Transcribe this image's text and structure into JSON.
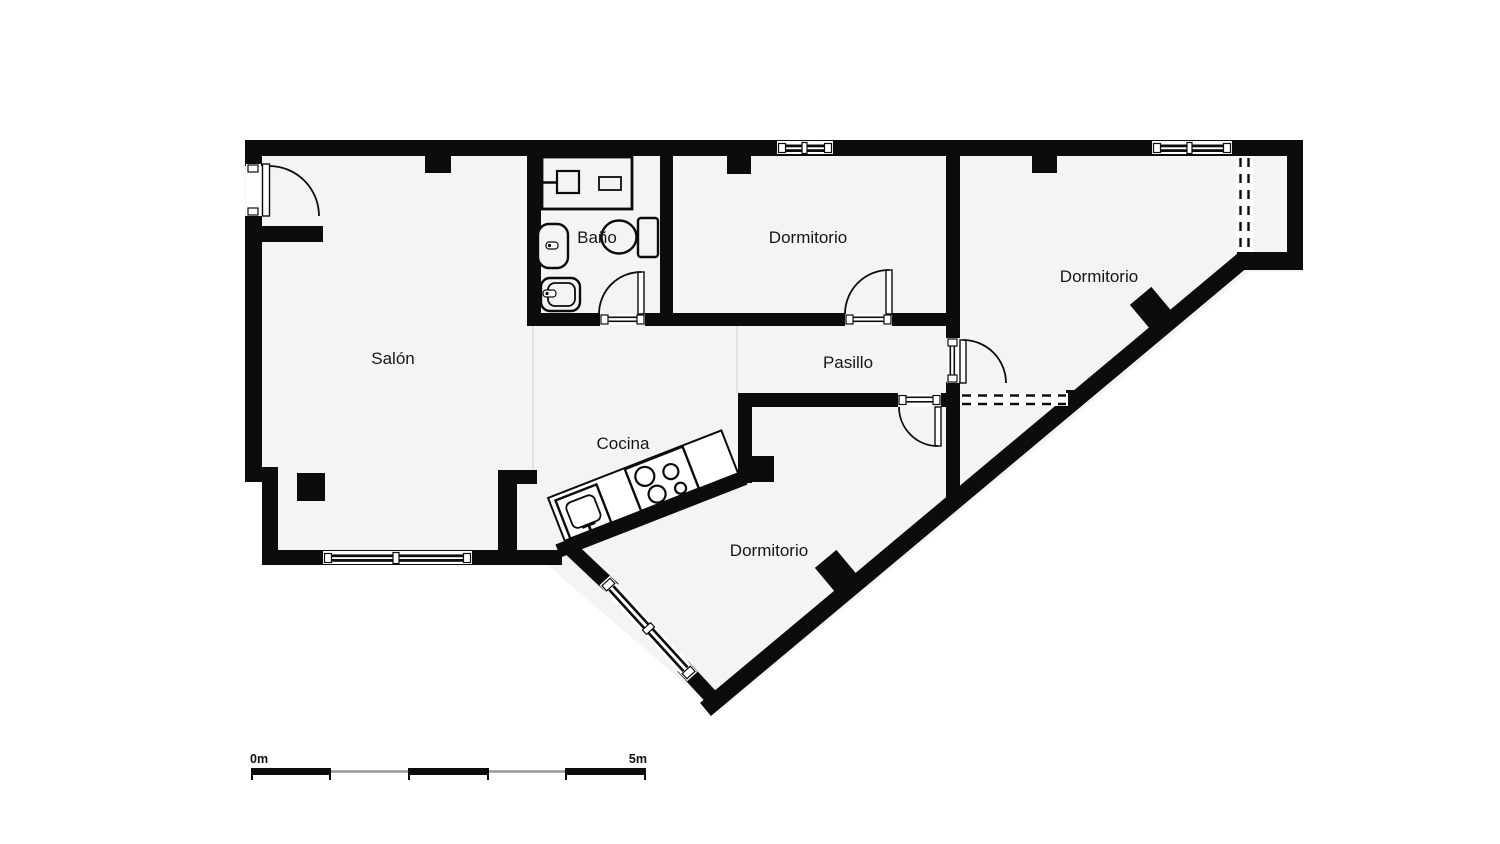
{
  "plan": {
    "type": "apartment-floor-plan",
    "labels": {
      "salon": "Salón",
      "bano": "Baño",
      "dormitorio_top": "Dormitorio",
      "dormitorio_right": "Dormitorio",
      "dormitorio_bottom": "Dormitorio",
      "pasillo": "Pasillo",
      "cocina": "Cocina"
    },
    "fixtures": [
      "shower",
      "toilet",
      "bidet",
      "washbasin",
      "kitchen-sink",
      "stove-4-burners"
    ],
    "colors": {
      "wall": "#0c0c0c",
      "room_fill": "#f4f4f4",
      "background": "#ffffff",
      "zone_divider": "#dcdcdc",
      "scale_alt": "#9a9a9a"
    }
  },
  "scale_bar": {
    "start": "0m",
    "end": "5m",
    "segments": 5
  }
}
